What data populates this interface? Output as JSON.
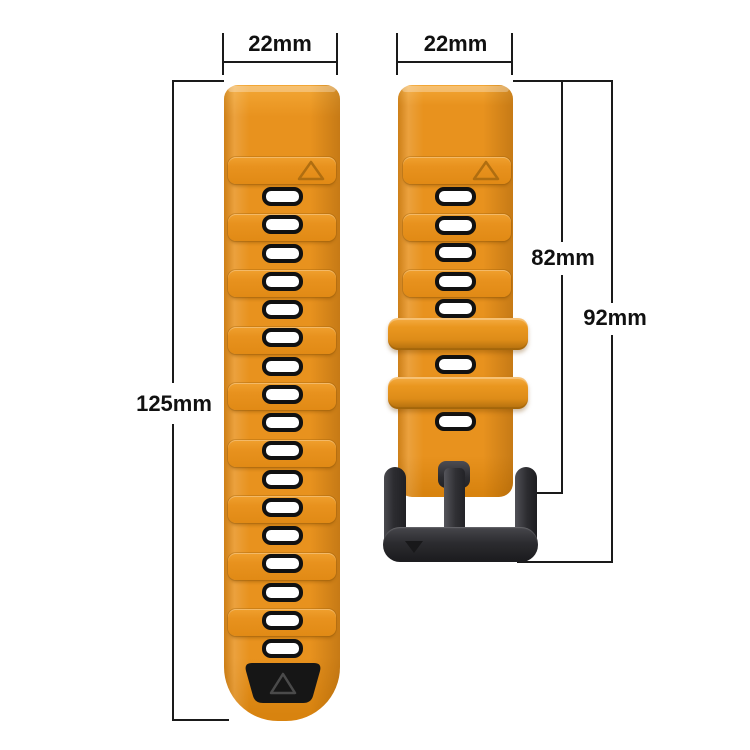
{
  "title": "Silicone watch band replacement strap — dimensions diagram",
  "colors": {
    "band_orange": "#e8921e",
    "band_orange_highlight": "#f3a735",
    "band_orange_shadow": "#c2770e",
    "groove_outline": "#b06e10",
    "hole_fill": "#ffffff",
    "hole_border": "#111111",
    "tip_panel_black": "#161616",
    "tip_triangle_stroke": "#4a4a4a",
    "buckle_metal_dark": "#2e2e31",
    "dimension_line": "#1a1a1a",
    "background": "#ffffff"
  },
  "dimensions": {
    "left_strap_width_label": "22mm",
    "right_strap_width_label": "22mm",
    "left_strap_length_label": "125mm",
    "right_strap_length_to_buckle_top_label": "82mm",
    "right_strap_length_overall_label": "92mm"
  },
  "left_strap": {
    "description": "long adjustment strap with holes",
    "visible_holes": 17,
    "ridge_segments": 9,
    "marks": [
      "triangle-outline-mark-top",
      "black-tip-panel-with-triangle"
    ]
  },
  "right_strap": {
    "description": "buckle-side strap",
    "visible_holes": 7,
    "ridge_segments": 3,
    "keeper_loops": 2,
    "marks": [
      "triangle-outline-mark-top",
      "buckle-triangle-mark"
    ]
  }
}
